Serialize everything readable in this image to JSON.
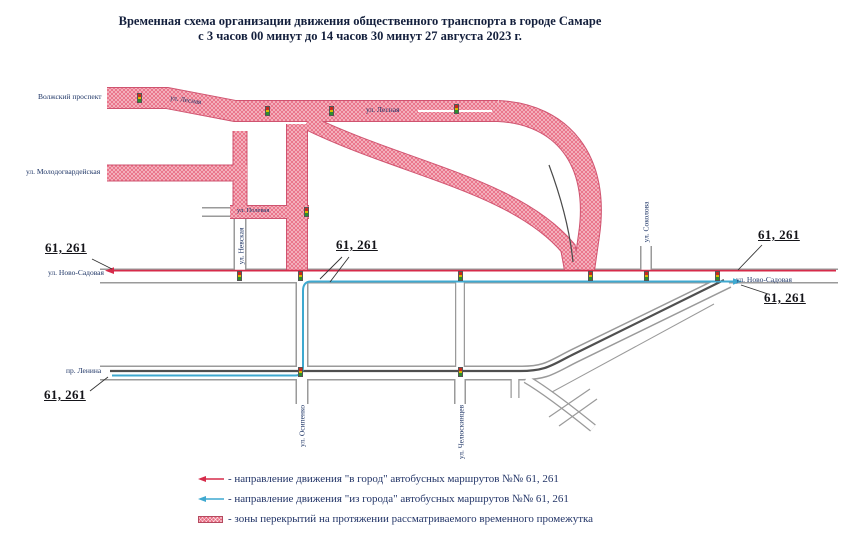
{
  "title": {
    "line1": "Временная схема организации движения общественного транспорта в городе Самаре",
    "line2": "с 3 часов 00 минут до 14 часов 30 минут 27 августа 2023 г."
  },
  "map": {
    "route_label": "61, 261",
    "streets": {
      "volzhsky": "Волжский проспект",
      "molodogvardeyskaya": "ул. Молодогвардейская",
      "lesnaya": "ул. Лесная",
      "polevaya": "ул. Полевая",
      "nevskaya": "ул. Невская",
      "sokolova": "ул. Соколова",
      "novo_sadovaya": "ул. Ново-Садовая",
      "lenina": "пр. Ленина",
      "osipenko": "ул. Осипенко",
      "chelyuskintsev": "ул. Челюскинцев"
    }
  },
  "legend": {
    "items": [
      {
        "icon": "in-city-arrow-icon",
        "text": "- направление движения \"в город\" автобусных маршрутов №№ 61, 261"
      },
      {
        "icon": "out-city-arrow-icon",
        "text": "- направление движения \"из города\" автобусных маршрутов №№ 61, 261"
      },
      {
        "icon": "closure-zone-icon",
        "text": "- зоны перекрытий на протяжении рассматриваемого временного промежутка"
      }
    ]
  },
  "colors": {
    "route_in": "#d62b4a",
    "route_out": "#3fa9d0",
    "closure": "#e8667e",
    "road_edge": "#9a9a9a",
    "street_label": "#1e3566"
  }
}
